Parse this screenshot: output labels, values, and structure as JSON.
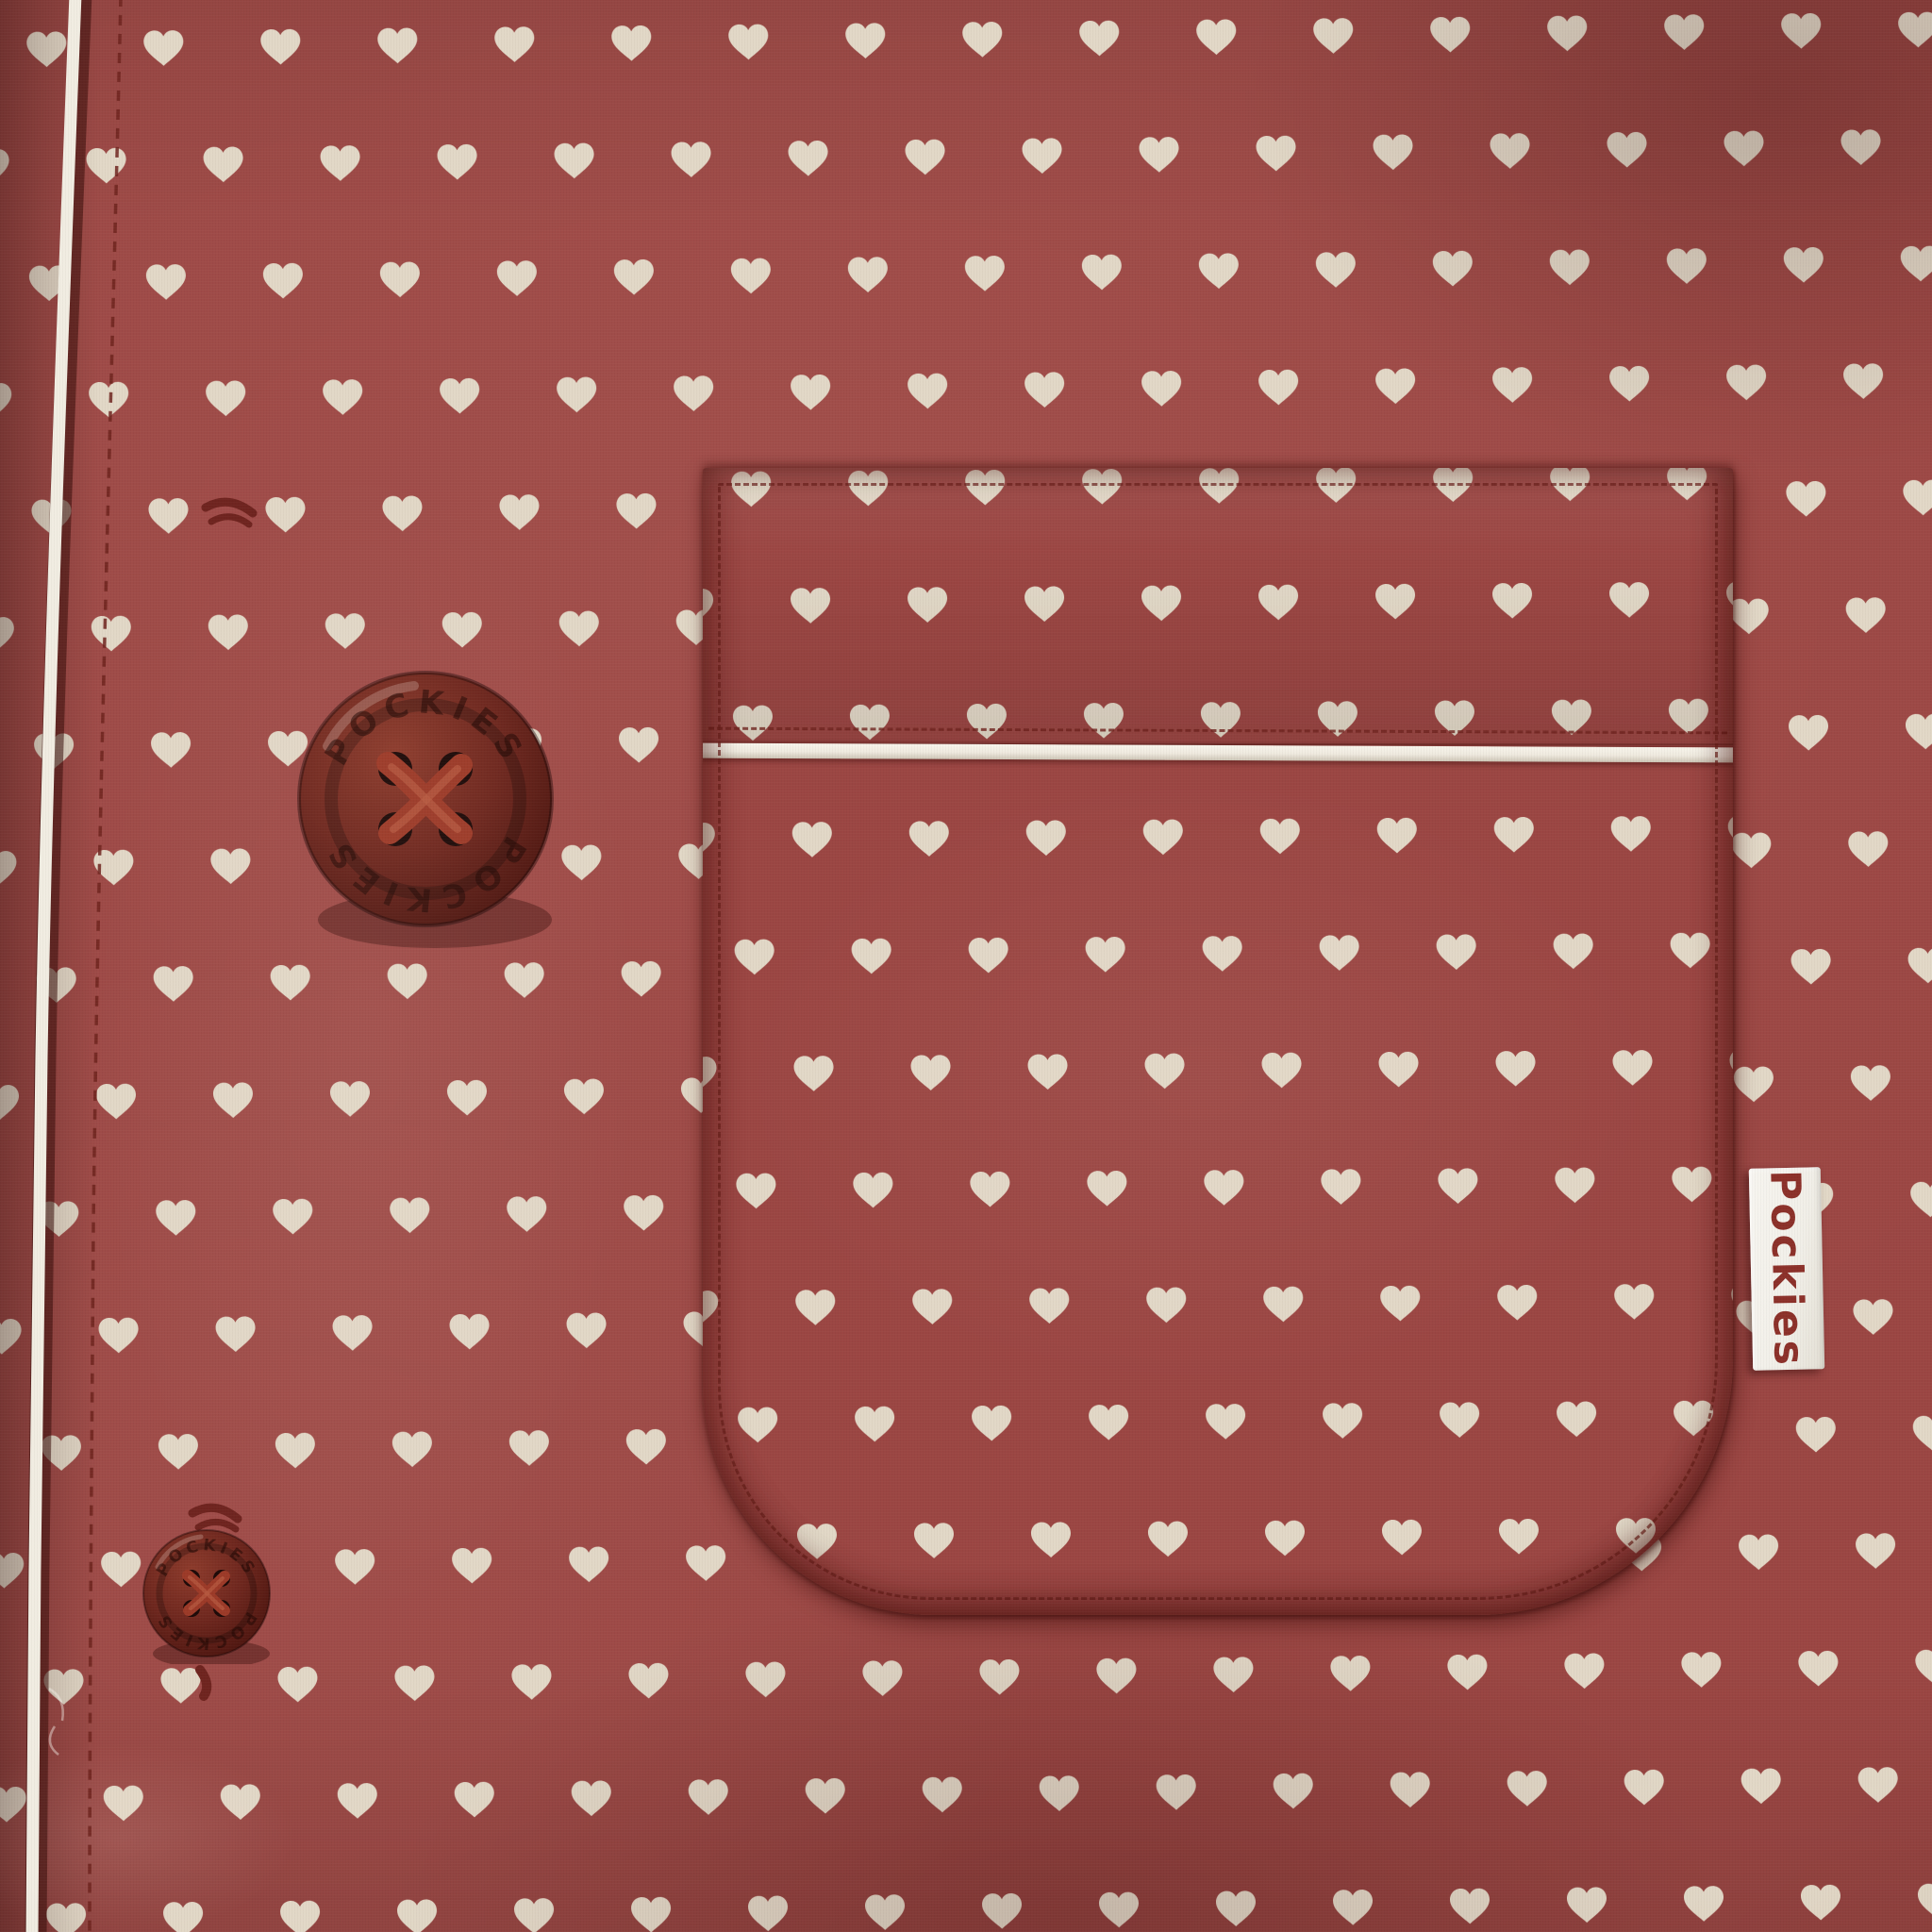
{
  "scene": {
    "subject": "close-up of a heart-print pajama shirt with chest pocket, piping, buttons and brand tag",
    "pattern_motif": "hearts"
  },
  "brand": {
    "tag_label": "Pockies",
    "button_emboss": "POCKIES"
  },
  "buttons": {
    "count": 2
  },
  "colors": {
    "fabric": "#9b4643",
    "fabric-shadow": "#6f2a27",
    "fabric-highlight": "#b05a52",
    "hearts": "#e2d8c7",
    "piping": "#f1ede2",
    "stitch": "#6f241f",
    "button-face": "#6e271e",
    "button-edge": "#4c150f",
    "button-holes": "#1d0a08",
    "thread": "#9c3a28",
    "tag-bg": "#f5f3ee",
    "tag-text": "#8c312a"
  }
}
